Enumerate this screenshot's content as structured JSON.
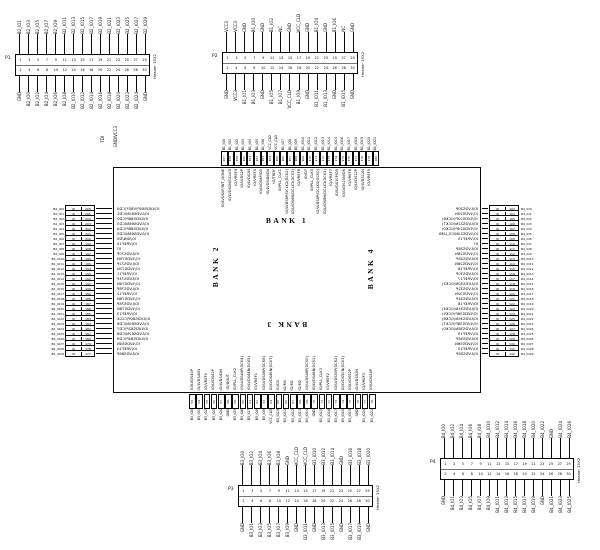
{
  "misc": {
    "tdi": "TDI",
    "pwr": "GND/VCC3"
  },
  "chip": {
    "banks": [
      "BANK 1",
      "BANK 2",
      "BANK 3",
      "BANK 4"
    ],
    "top": [
      {
        "net": "B1_IO0",
        "pin": "157",
        "fn": "IO/LVDS0P/INT_DONE"
      },
      {
        "net": "B1_IO1",
        "pin": "158",
        "fn": "IO/LVDS0N/GCLK5"
      },
      {
        "net": "B1_IO2",
        "pin": "159",
        "fn": "IO/VREF4"
      },
      {
        "net": "B1_IO3",
        "pin": "160",
        "fn": "IO/LVDS2P"
      },
      {
        "net": "B1_IO4",
        "pin": "161",
        "fn": "IO/LVDS2N"
      },
      {
        "net": "B1_IO5",
        "pin": "162",
        "fn": "IO/VREF5"
      },
      {
        "net": "B1_IO6",
        "pin": "163",
        "fn": "IO/LVDS4P/D3"
      },
      {
        "net": "VCC_CLD",
        "pin": "164",
        "fn": "IO/LVDS4N/D4"
      },
      {
        "net": "VCC_CLD",
        "pin": "165",
        "fn": "IO/TRDY"
      },
      {
        "net": "B1_IO7",
        "pin": "166",
        "fn": "IO/PLL_CLK1"
      },
      {
        "net": "B1_IO8",
        "pin": "167",
        "fn": "IO/LVDS6P/GCLK2(GCK2)"
      },
      {
        "net": "B1_IO9",
        "pin": "168",
        "fn": "IO/LVDS6N/GCLK3(GCK3)"
      },
      {
        "net": "B1_IO10",
        "pin": "169",
        "fn": "IO/VREF6"
      },
      {
        "net": "B1_IO11",
        "pin": "170",
        "fn": "IO/D7"
      },
      {
        "net": "B1_IO12",
        "pin": "171",
        "fn": "IO/PLL_CLK0"
      },
      {
        "net": "B1_IO13",
        "pin": "172",
        "fn": "IO/LVDS8P/GCLK0(GCK0)"
      },
      {
        "net": "B1_IO14",
        "pin": "173",
        "fn": "IO/LVDS8N/GCLK1(GCK1)"
      },
      {
        "net": "B1_IO15",
        "pin": "174",
        "fn": "IO/VREF7"
      },
      {
        "net": "B1_IO16",
        "pin": "175",
        "fn": "IO/LVDS10P/D5"
      },
      {
        "net": "B1_IO17",
        "pin": "176",
        "fn": "IO/LVDS10N/D6"
      },
      {
        "net": "B1_IO18",
        "pin": "177",
        "fn": "IO/VREF8"
      },
      {
        "net": "B1_IO19",
        "pin": "178",
        "fn": "IO/LVDS12P"
      },
      {
        "net": "B1_IO20",
        "pin": "179",
        "fn": "IO/LVDS12N"
      },
      {
        "net": "B1_IO21",
        "pin": "180",
        "fn": "IO/VREF9"
      }
    ],
    "left": [
      {
        "net": "B2_IO0",
        "cell": "IO",
        "pin": "206",
        "fn": "IO/LVDS64P/VREF/CD0"
      },
      {
        "net": "B2_IO1",
        "cell": "IO",
        "pin": "205",
        "fn": "IO/LVDS64N/CD1"
      },
      {
        "net": "B2_IO2",
        "cell": "IO",
        "pin": "204",
        "fn": "IO/LVDS66P/CD2"
      },
      {
        "net": "B2_IO3",
        "cell": "IO",
        "pin": "203",
        "fn": "IO/LVDS66N/CD3"
      },
      {
        "net": "B2_IO4",
        "cell": "IO",
        "pin": "202",
        "fn": "IO/LVDS68P/CD4"
      },
      {
        "net": "B2_IO5",
        "cell": "IO",
        "pin": "201",
        "fn": "IO/LVDS68N/CD5"
      },
      {
        "net": "B2_IO6",
        "cell": "IO",
        "pin": "200",
        "fn": "IO/DIN/D0"
      },
      {
        "net": "B2_IO7",
        "cell": "IO",
        "pin": "199",
        "fn": "IO/VREF10"
      },
      {
        "net": "B2_IO8",
        "cell": "IO",
        "pin": "198",
        "fn": "IO"
      },
      {
        "net": "B2_IO9",
        "cell": "IO",
        "pin": "197",
        "fn": "IO/LVDS70P"
      },
      {
        "net": "B2_IO10",
        "cell": "IO",
        "pin": "196",
        "fn": "IO/LVDS70N"
      },
      {
        "net": "B2_IO11",
        "cell": "IO",
        "pin": "195",
        "fn": "IO/LVDS72P"
      },
      {
        "net": "B2_IO12",
        "cell": "IO",
        "pin": "194",
        "fn": "IO/LVDS72N"
      },
      {
        "net": "B2_IO13",
        "cell": "IO",
        "pin": "193",
        "fn": "IO/VREF11"
      },
      {
        "net": "B2_IO14",
        "cell": "IO",
        "pin": "192",
        "fn": "IO/LVDS74P"
      },
      {
        "net": "B2_IO15",
        "cell": "IO",
        "pin": "191",
        "fn": "IO/LVDS74N"
      },
      {
        "net": "B2_IO16",
        "cell": "IO",
        "pin": "190",
        "fn": "IO/LVDS76P"
      },
      {
        "net": "B2_IO17",
        "cell": "IO",
        "pin": "189",
        "fn": "IO/VREF12"
      },
      {
        "net": "B2_IO18",
        "cell": "IO",
        "pin": "188",
        "fn": "IO/LVDS76N"
      },
      {
        "net": "B2_IO19",
        "cell": "IO",
        "pin": "187",
        "fn": "IO/LVDS78P"
      },
      {
        "net": "B2_IO20",
        "cell": "IO",
        "pin": "186",
        "fn": "IO/LVDS78N"
      },
      {
        "net": "B2_IO21",
        "cell": "IO",
        "pin": "185",
        "fn": "IO/VREF13"
      },
      {
        "net": "B2_IO22",
        "cell": "IO",
        "pin": "184",
        "fn": "IO/LVDS80P/CCLK"
      },
      {
        "net": "B2_IO23",
        "cell": "IO",
        "pin": "183",
        "fn": "IO/LVDS80N/CD6"
      },
      {
        "net": "B2_IO24",
        "cell": "IO",
        "pin": "182",
        "fn": "IO/LVDS82P/CD7"
      },
      {
        "net": "B2_IO25",
        "cell": "IO",
        "pin": "181",
        "fn": "IO/LVDS82N/CD8"
      },
      {
        "net": "B2_IO26",
        "cell": "IO",
        "pin": "180",
        "fn": "IO/LVDS84P/CD9"
      },
      {
        "net": "B2_IO27",
        "cell": "IO",
        "pin": "179",
        "fn": "IO/LVDS84N"
      },
      {
        "net": "B2_IO28",
        "cell": "IO",
        "pin": "178",
        "fn": "IO/VREF14"
      },
      {
        "net": "B2_IO29",
        "cell": "IO",
        "pin": "177",
        "fn": "IO/LVDS86P"
      }
    ],
    "right": [
      {
        "pin": "103",
        "cell": "IO",
        "net": "B4_IO0",
        "fn": "IO/LVDS20P"
      },
      {
        "pin": "104",
        "cell": "IO",
        "net": "B4_IO1",
        "fn": "IO/LVDS20N"
      },
      {
        "pin": "105",
        "cell": "IO",
        "net": "B4_IO2",
        "fn": "IO/LVDS22P(GCK6)"
      },
      {
        "pin": "106",
        "cell": "IO",
        "net": "B4_IO3",
        "fn": "IO/LVDS22N(GCK7)"
      },
      {
        "pin": "107",
        "cell": "IO",
        "net": "B4_IO4",
        "fn": "IO/LVDS24P(GCK0)"
      },
      {
        "pin": "108",
        "cell": "IO",
        "net": "B4_IO5",
        "fn": "IO/LVDS24N/CS_LMB"
      },
      {
        "pin": "109",
        "cell": "IO",
        "net": "B4_IO6",
        "fn": "IO/VREF15"
      },
      {
        "pin": "110",
        "cell": "IO",
        "net": "B4_IO7",
        "fn": "IO"
      },
      {
        "pin": "111",
        "cell": "IO",
        "net": "B4_IO8",
        "fn": "IO/LVDS26P"
      },
      {
        "pin": "112",
        "cell": "IO",
        "net": "B4_IO9",
        "fn": "IO/LVDS26N"
      },
      {
        "pin": "113",
        "cell": "IO",
        "net": "B4_IO10",
        "fn": "IO/LVDS28P"
      },
      {
        "pin": "114",
        "cell": "IO",
        "net": "B4_IO11",
        "fn": "IO/LVDS28N"
      },
      {
        "pin": "115",
        "cell": "IO",
        "net": "B4_IO12",
        "fn": "IO/VREF16"
      },
      {
        "pin": "116",
        "cell": "IO",
        "net": "B4_IO13",
        "fn": "IO/LVDS30P"
      },
      {
        "pin": "117",
        "cell": "IO",
        "net": "B4_IO14",
        "fn": "IO/VREF17"
      },
      {
        "pin": "118",
        "cell": "IO",
        "net": "B4_IO15",
        "fn": "IO/LVDS30N(GCK2)"
      },
      {
        "pin": "119",
        "cell": "IO",
        "net": "B4_IO16",
        "fn": "IO/LVDS32P"
      },
      {
        "pin": "120",
        "cell": "IO",
        "net": "B4_IO17",
        "fn": "IO/LVDS32N"
      },
      {
        "pin": "121",
        "cell": "IO",
        "net": "B4_IO18",
        "fn": "IO/LVDS34P"
      },
      {
        "pin": "122",
        "cell": "IO",
        "net": "B4_IO19",
        "fn": "IO/VREF18"
      },
      {
        "pin": "123",
        "cell": "IO",
        "net": "B4_IO20",
        "fn": "IO/LVDS34N(GCK4)"
      },
      {
        "pin": "124",
        "cell": "IO",
        "net": "B4_IO21",
        "fn": "IO/LVDS36P(GCK5)"
      },
      {
        "pin": "125",
        "cell": "IO",
        "net": "B4_IO22",
        "fn": "IO/LVDS36N(GCK6)"
      },
      {
        "pin": "126",
        "cell": "IO",
        "net": "B4_IO23",
        "fn": "IO/LVDS38P(GCK7)"
      },
      {
        "pin": "127",
        "cell": "IO",
        "net": "B4_IO24",
        "fn": "IO/LVDS38N(GCK0)"
      },
      {
        "pin": "128",
        "cell": "IO",
        "net": "B4_IO25",
        "fn": "IO/VREF19"
      },
      {
        "pin": "129",
        "cell": "IO",
        "net": "B4_IO26",
        "fn": "IO/LVDS56P"
      },
      {
        "pin": "130",
        "cell": "IO",
        "net": "B4_IO27",
        "fn": "IO/LVDS56N"
      },
      {
        "pin": "131",
        "cell": "IO",
        "net": "B4_IO28",
        "fn": "IO/VREF20"
      },
      {
        "pin": "132",
        "cell": "IO",
        "net": "B4_IO29",
        "fn": "IO/LVDS58P"
      }
    ],
    "bottom": [
      {
        "pin": "53",
        "net": "B3_IO0",
        "fn": "IO/LVDS40P"
      },
      {
        "pin": "54",
        "net": "B3_IO1",
        "fn": "IO/LVDS40N"
      },
      {
        "pin": "55",
        "net": "B3_IO2",
        "fn": "IO/VREF0"
      },
      {
        "pin": "56",
        "net": "B3_IO3",
        "fn": "IO/LVDS42P"
      },
      {
        "pin": "57",
        "net": "B3_IO4",
        "fn": "IO/LVDS42N"
      },
      {
        "pin": "58",
        "net": "GND",
        "fn": "IO/DOUT"
      },
      {
        "pin": "59",
        "net": "B3_IO5",
        "fn": "IO/PLL_CLK2"
      },
      {
        "pin": "60",
        "net": "B3_IO6",
        "fn": "IO/LVDS44P(GCK4)"
      },
      {
        "pin": "61",
        "net": "B3_IO7",
        "fn": "IO/LVDS44N(GCK5)"
      },
      {
        "pin": "62",
        "net": "B3_IO8",
        "fn": "IO/VREF1"
      },
      {
        "pin": "63",
        "net": "B3_IO9",
        "fn": "IO/LVDS46P(GCK6)"
      },
      {
        "pin": "64",
        "net": "VCC_CLD",
        "fn": "IO/LVDS46N(GCK7)"
      },
      {
        "pin": "65",
        "net": "B3_IO10",
        "fn": "IO/D0"
      },
      {
        "pin": "66",
        "net": "B3_IO11",
        "fn": "IO/M0"
      },
      {
        "pin": "67",
        "net": "B3_IO12",
        "fn": "IO/M1"
      },
      {
        "pin": "68",
        "net": "B3_IO13",
        "fn": "IO/M2"
      },
      {
        "pin": "69",
        "net": "B3_IO14",
        "fn": "IO/LVDS48P(GCK0)"
      },
      {
        "pin": "70",
        "net": "GND",
        "fn": "IO/LVDS48N(GCK1)"
      },
      {
        "pin": "71",
        "net": "B3_IO15",
        "fn": "IO/PLL_CLK3"
      },
      {
        "pin": "72",
        "net": "B3_IO16",
        "fn": "IO/VREF2"
      },
      {
        "pin": "73",
        "net": "B3_IO17",
        "fn": "IO/LVDS50P(GCK2)"
      },
      {
        "pin": "74",
        "net": "B3_IO18",
        "fn": "IO/LVDS50N(GCK3)"
      },
      {
        "pin": "75",
        "net": "B3_IO19",
        "fn": "IO/LVDS52P"
      },
      {
        "pin": "76",
        "net": "GND",
        "fn": "IO/LVDS52N"
      },
      {
        "pin": "77",
        "net": "B3_IO20",
        "fn": "IO/VREF3"
      },
      {
        "pin": "78",
        "net": "B3_IO21",
        "fn": "IO/LVDS54P"
      }
    ]
  },
  "headers": [
    {
      "id": "P1",
      "refdes": "P1",
      "part": "Header 15X2",
      "top_labels": [
        "B2_IO1",
        "B2_IO3",
        "B2_IO5",
        "B2_IO7",
        "B2_IO9",
        "B2_IO11",
        "B2_IO13",
        "B2_IO15",
        "B2_IO17",
        "B2_IO19",
        "B2_IO21",
        "B2_IO23",
        "B2_IO25",
        "B2_IO27",
        "B2_IO29"
      ],
      "bottom_labels": [
        "GND",
        "B2_IO0",
        "B2_IO2",
        "B2_IO4",
        "B2_IO6",
        "B2_IO8",
        "B2_IO10",
        "B2_IO12",
        "B2_IO14",
        "B2_IO16",
        "B2_IO18",
        "B2_IO20",
        "B2_IO22",
        "B2_IO24",
        "GND"
      ],
      "top_pins": [
        "1",
        "3",
        "5",
        "7",
        "9",
        "11",
        "13",
        "15",
        "17",
        "19",
        "21",
        "23",
        "25",
        "27",
        "29"
      ],
      "bottom_pins": [
        "2",
        "4",
        "6",
        "8",
        "10",
        "12",
        "14",
        "16",
        "18",
        "20",
        "22",
        "24",
        "26",
        "28",
        "30"
      ]
    },
    {
      "id": "P2",
      "refdes": "P2",
      "part": "Header 15X2",
      "top_labels": [
        "VCC3",
        "VCC3",
        "GND",
        "B1_IO0",
        "GND",
        "B1_IO2",
        "NC",
        "GND",
        "VCC_CLD",
        "GND",
        "B1_IO4",
        "GND",
        "B1_IO6",
        "NC",
        "GND"
      ],
      "bottom_labels": [
        "GND",
        "VCC3",
        "B1_IO1",
        "B1_IO3",
        "GND",
        "B1_IO5",
        "B1_IO7",
        "VCC_CLD",
        "B1_IO9",
        "GND",
        "B1_IO11",
        "B1_IO13",
        "GND",
        "B1_IO15",
        "GND"
      ],
      "top_pins": [
        "1",
        "3",
        "5",
        "7",
        "9",
        "11",
        "13",
        "15",
        "17",
        "19",
        "21",
        "23",
        "25",
        "27",
        "29"
      ],
      "bottom_pins": [
        "2",
        "4",
        "6",
        "8",
        "10",
        "12",
        "14",
        "16",
        "18",
        "20",
        "22",
        "24",
        "26",
        "28",
        "30"
      ]
    },
    {
      "id": "P3",
      "refdes": "P3",
      "part": "Header 15X2",
      "top_labels": [
        "B3_IO0",
        "B3_IO2",
        "B3_IO4",
        "B3_IO6",
        "B3_IO8",
        "GND",
        "VCC_CLD",
        "VCC_CLD",
        "B3_IO10",
        "B3_IO12",
        "B3_IO14",
        "GND",
        "B3_IO16",
        "B3_IO18",
        "B3_IO20"
      ],
      "bottom_labels": [
        "GND",
        "B3_IO1",
        "B3_IO3",
        "B3_IO5",
        "B3_IO7",
        "B3_IO9",
        "GND",
        "B3_IO11",
        "GND",
        "B3_IO13",
        "B3_IO15",
        "GND",
        "B3_IO17",
        "B3_IO19",
        "GND"
      ],
      "top_pins": [
        "1",
        "3",
        "5",
        "7",
        "9",
        "11",
        "13",
        "15",
        "17",
        "19",
        "21",
        "23",
        "25",
        "27",
        "29"
      ],
      "bottom_pins": [
        "2",
        "4",
        "6",
        "8",
        "10",
        "12",
        "14",
        "16",
        "18",
        "20",
        "22",
        "24",
        "26",
        "28",
        "30"
      ]
    },
    {
      "id": "P4",
      "refdes": "P4",
      "part": "Header 15X2",
      "top_labels": [
        "B4_IO0",
        "B4_IO2",
        "B4_IO4",
        "B4_IO6",
        "B4_IO8",
        "B4_IO10",
        "B4_IO12",
        "B4_IO14",
        "B4_IO16",
        "B4_IO18",
        "B4_IO20",
        "B4_IO22",
        "GND",
        "B4_IO24",
        "B4_IO26"
      ],
      "bottom_labels": [
        "GND",
        "B4_IO1",
        "B4_IO3",
        "B4_IO5",
        "B4_IO7",
        "B4_IO9",
        "B4_IO11",
        "B4_IO13",
        "B4_IO15",
        "B4_IO17",
        "B4_IO19",
        "GND",
        "B4_IO21",
        "B4_IO23",
        "B4_IO25"
      ],
      "top_pins": [
        "1",
        "3",
        "5",
        "7",
        "9",
        "11",
        "13",
        "15",
        "17",
        "19",
        "21",
        "23",
        "25",
        "27",
        "29"
      ],
      "bottom_pins": [
        "2",
        "4",
        "6",
        "8",
        "10",
        "12",
        "14",
        "16",
        "18",
        "20",
        "22",
        "24",
        "26",
        "28",
        "30"
      ]
    }
  ]
}
